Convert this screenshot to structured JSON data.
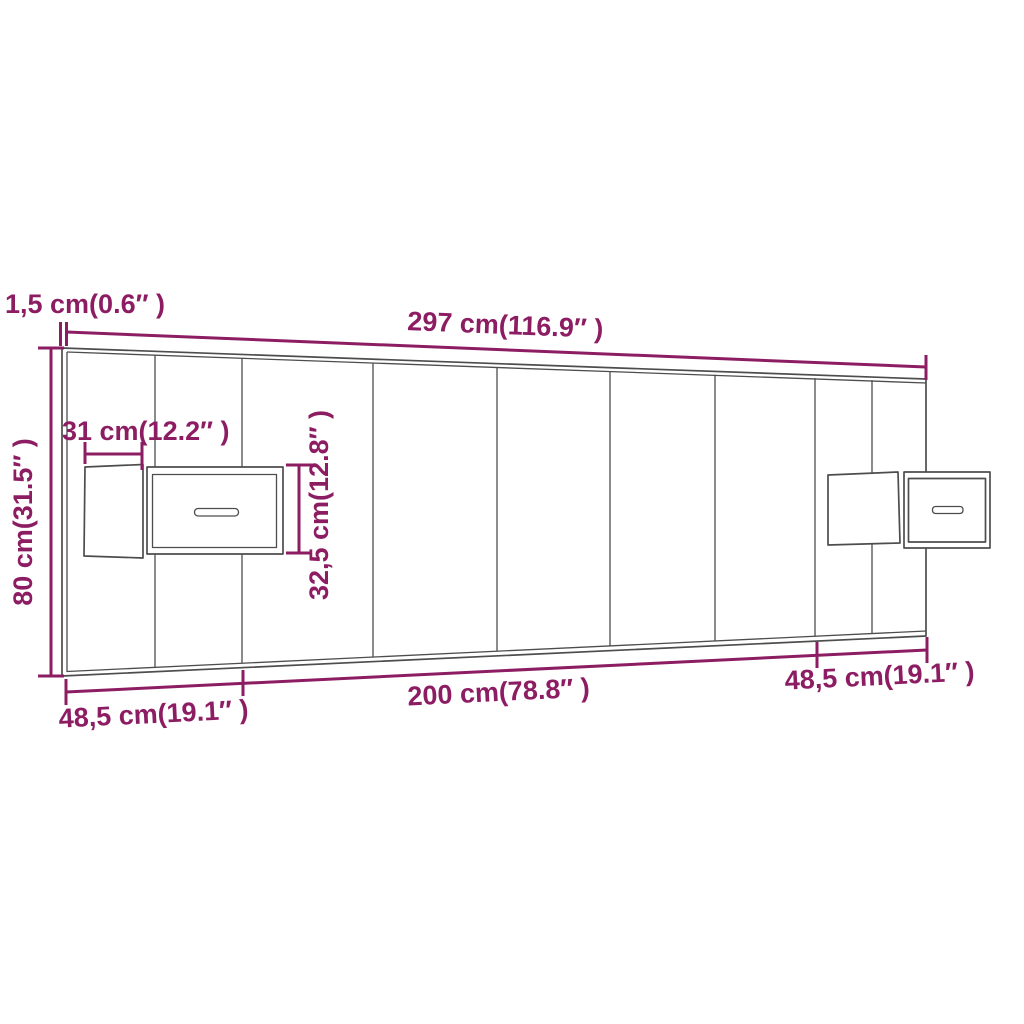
{
  "colors": {
    "dimension": "#8d1d63",
    "line": "#4d4d4d",
    "background": "#ffffff"
  },
  "labels": {
    "panel_thickness": "1,5 cm(0.6″ )",
    "total_width": "297 cm(116.9″ )",
    "total_height": "80 cm(31.5″ )",
    "nightstand_depth": "31 cm(12.2″ )",
    "nightstand_height": "32,5 cm(12.8″ )",
    "left_section": "48,5 cm(19.1″ )",
    "center_section": "200 cm(78.8″ )",
    "right_section": "48,5 cm(19.1″ )"
  }
}
